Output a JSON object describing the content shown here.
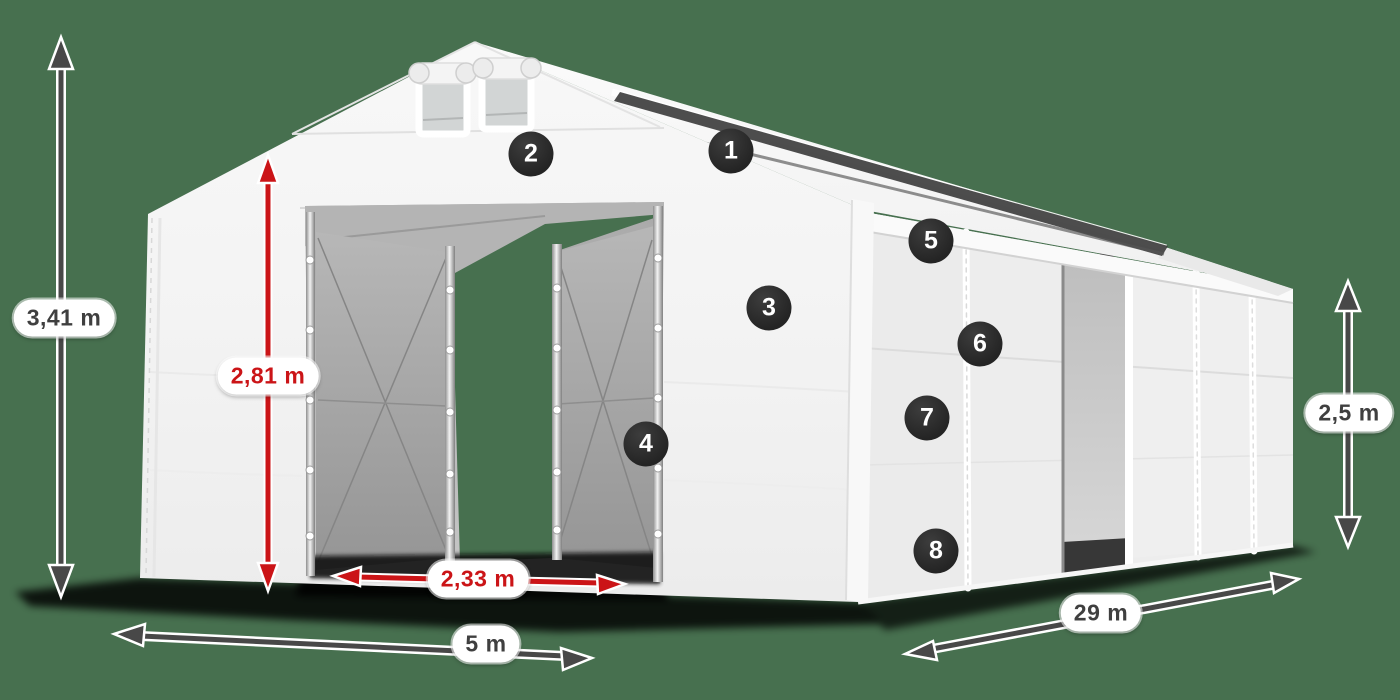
{
  "scene": {
    "type": "product-dimension-diagram",
    "subject": "white storage tent / tent hall with open front entrance",
    "background_color": "#47704F",
    "accent_red": "#CB1417",
    "arrow_dark": "#484848",
    "badge_color": "#2B2B2B"
  },
  "measurements": {
    "total_height": "3,41 m",
    "entrance_height": "2,81 m",
    "entrance_width": "2,33 m",
    "front_width": "5 m",
    "side_length": "29 m",
    "side_wall_height": "2,5 m"
  },
  "badges": [
    {
      "number": "1"
    },
    {
      "number": "2"
    },
    {
      "number": "3"
    },
    {
      "number": "4"
    },
    {
      "number": "5"
    },
    {
      "number": "6"
    },
    {
      "number": "7"
    },
    {
      "number": "8"
    }
  ]
}
